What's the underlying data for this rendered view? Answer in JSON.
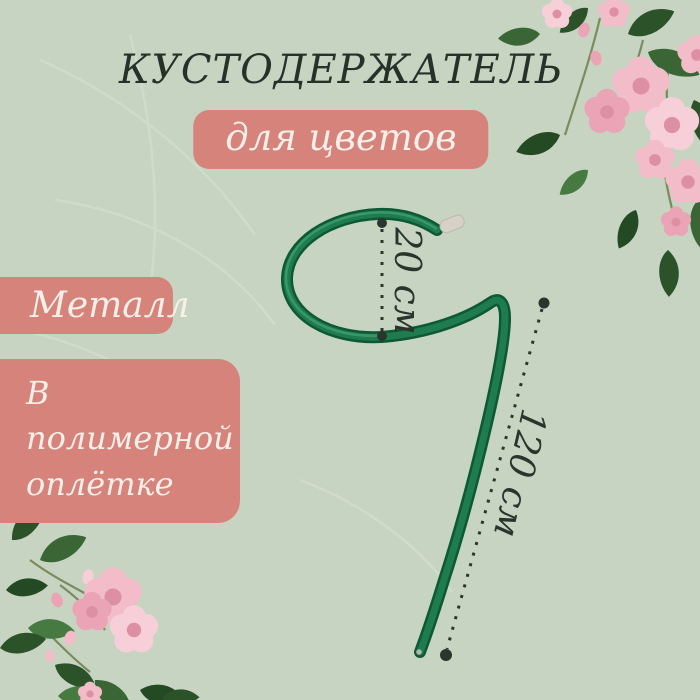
{
  "title": "КУСТОДЕРЖАТЕЛЬ",
  "subtitle_badge": "для цветов",
  "feature_badges": [
    {
      "label": "Металл"
    },
    {
      "label": "В полимерной оплётке"
    }
  ],
  "dimensions": {
    "hook_diameter": "20 см",
    "height": "120 см"
  },
  "decor": {
    "top_right": "pink-rose-cluster",
    "bottom_left": "pink-rose-cluster",
    "background": "faint-leaf-watermark"
  },
  "colors": {
    "background": "#c7d4c2",
    "title_text": "#263229",
    "badge_fill": "#d6837c",
    "badge_text": "#f7efe8",
    "rod_green_dark": "#0d5835",
    "rod_green_mid": "#1e7c4e",
    "rod_cap": "#d7d2c7",
    "dimension_ink": "#2a342c",
    "ground_line": "#b9c2b2",
    "flower_pink": "#f2bcc8",
    "leaf_green": "#3a6635"
  }
}
